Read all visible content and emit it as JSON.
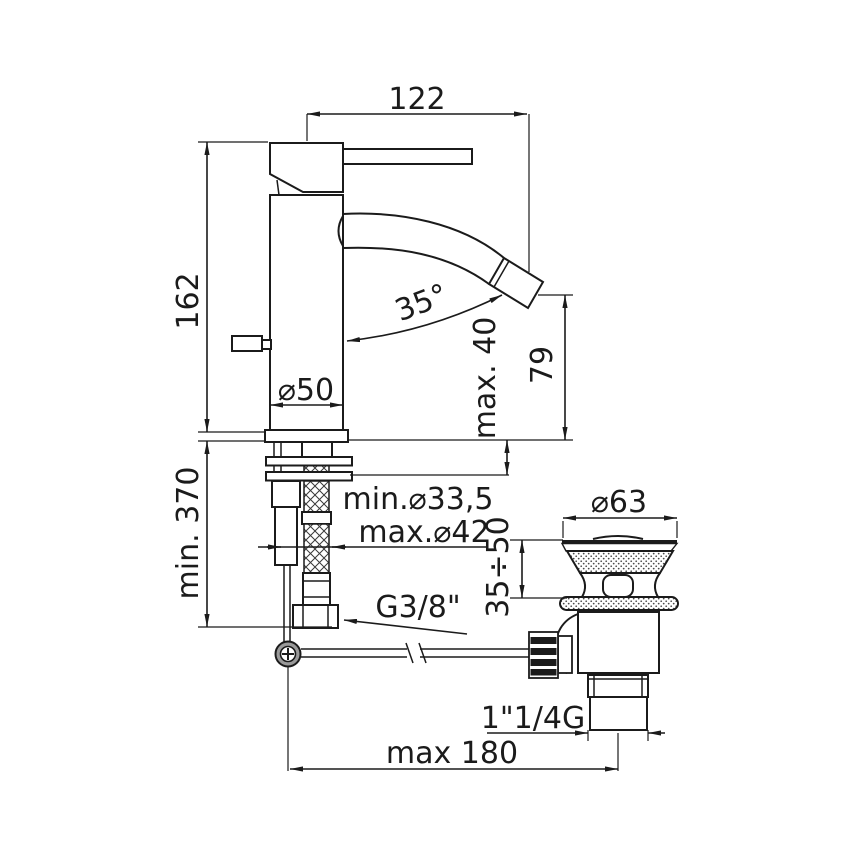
{
  "drawing": {
    "type": "faucet-technical-drawing",
    "line_color": "#1b1b1b",
    "background_color": "#ffffff",
    "labels": {
      "spout_reach": "122",
      "height_to_deck": "162",
      "spout_angle": "35°",
      "max_deck_thickness": "max. 40",
      "spout_outlet_height": "79",
      "body_diameter": "⌀50",
      "min_hose_length": "min. 370",
      "min_hole_diameter": "min.⌀33,5",
      "max_hole_diameter": "max.⌀42",
      "supply_thread": "G3/8\"",
      "waste_flange_diameter": "⌀63",
      "waste_clamping_range": "35÷50",
      "waste_thread": "1\"1/4G",
      "max_rod_reach": "max 180"
    }
  }
}
